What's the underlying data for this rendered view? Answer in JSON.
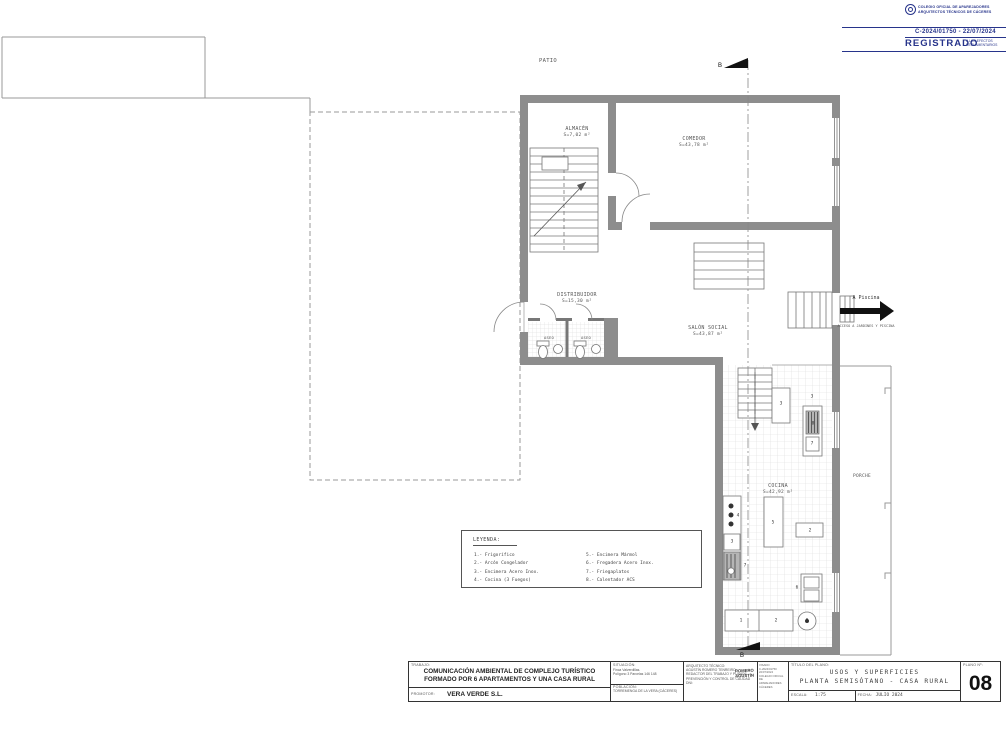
{
  "stamp": {
    "org_line1": "COLEGIO OFICIAL DE APAREJADORES",
    "org_line2": "ARQUITECTOS TÉCNICOS DE CÁCERES",
    "number": "C-2024/01750 - 22/07/2024",
    "registered": "REGISTRADO",
    "effects_line1": "A LOS EFECTOS",
    "effects_line2": "REGLAMENTARIOS"
  },
  "plan": {
    "patio": "PATIO",
    "rooms": {
      "almacen": {
        "name": "ALMACÉN",
        "area": "S=7,02 m²"
      },
      "comedor": {
        "name": "COMEDOR",
        "area": "S=43,78 m²"
      },
      "distribuidor": {
        "name": "DISTRIBUIDOR",
        "area": "S=15,30 m²"
      },
      "salon": {
        "name": "SALÓN SOCIAL",
        "area": "S=43,87 m²"
      },
      "aseo1": {
        "name": "ASEO"
      },
      "aseo2": {
        "name": "ASEO"
      },
      "cocina": {
        "name": "COCINA",
        "area": "S=42,92 m²"
      },
      "porche": {
        "name": "PORCHE"
      }
    },
    "section_mark_top": "B",
    "section_mark_bottom": "B",
    "pool": {
      "title": "A Piscina",
      "subtitle": "ACCESO A JARDINES Y PISCINA"
    },
    "fixture_labels": [
      "3",
      "3",
      "8",
      "7",
      "2",
      "5",
      "4",
      "3",
      "7",
      "1",
      "2",
      "8",
      "6"
    ]
  },
  "legend": {
    "title": "LEYENDA:",
    "left": [
      "1.- Frigorífico",
      "2.- Arcón Congelador",
      "3.- Encimera Acero Inox.",
      "4.- Cocina (3 Fuegos)"
    ],
    "right": [
      "5.- Encimera Mármol",
      "6.- Fregadera Acero Inox.",
      "7.- Friegaplatos",
      "8.- Calentador ACS"
    ]
  },
  "titleblock": {
    "trabajo_label": "TRABAJO:",
    "trabajo_line1": "COMUNICACIÓN AMBIENTAL DE COMPLEJO TURÍSTICO",
    "trabajo_line2": "FORMADO POR 6 APARTAMENTOS Y UNA CASA RURAL",
    "promotor_label": "PROMOTOR:",
    "promotor_value": "VERA VERDE S.L.",
    "situacion_label": "SITUACIÓN:",
    "situacion_line1": "Finca Valverdillas.",
    "situacion_line2": "Polígono 3 Parcelas 146 148",
    "poblacion_label": "POBLACIÓN:",
    "poblacion_value": "TORREMENGA DE LA VERA (CÁCERES)",
    "arq_label": "ARQUITECTO TÉCNICO:",
    "arq_name": "AGUSTÍN ROMERO TENREIRO",
    "arq_line3": "REDACTOR DEL TRABAJO Y PLANOS",
    "arq_line4": "PREVENCIÓN Y CONTROL DE CALIDAD",
    "arq_line5": "DNI:",
    "arq_stamp1": "ROMERO",
    "arq_stamp2": "AGUSTÍN",
    "visado1": "VISADO",
    "visado2": "C-2024/01750",
    "visado3": "22/07/2024",
    "visado4": "COLEGIO OFICIAL DE",
    "visado5": "APAREJADORES CÁCERES",
    "titulo_label": "TÍTULO DEL PLANO:",
    "titulo_line1": "USOS Y SUPERFICIES",
    "titulo_line2": "PLANTA SEMISÓTANO - CASA RURAL",
    "escala_label": "ESCALA:",
    "escala_value": "1:75",
    "fecha_label": "FECHA:",
    "fecha_value": "JULIO 2024",
    "plano_label": "PLANO Nº:",
    "plano_value": "08"
  }
}
